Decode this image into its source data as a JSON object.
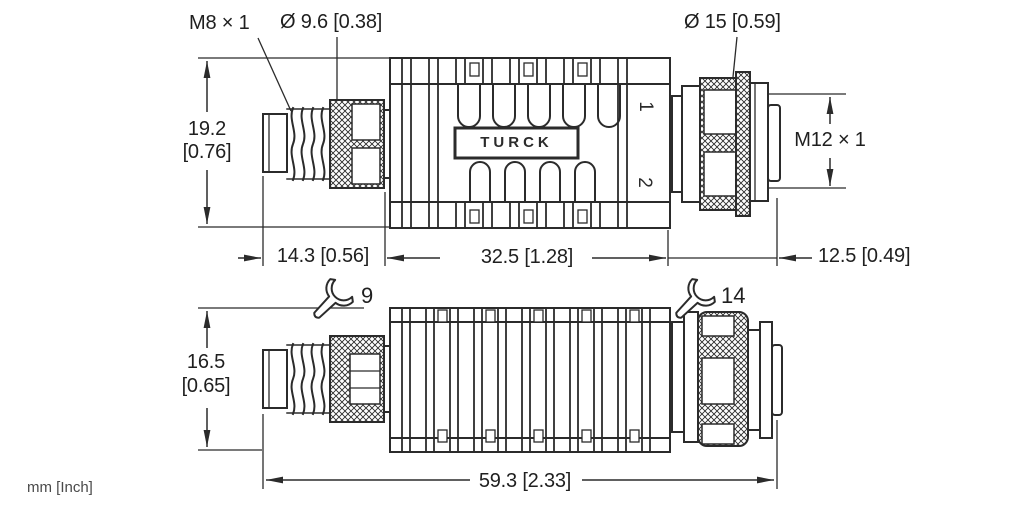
{
  "units_label": "mm [Inch]",
  "brand_label": "TURCK",
  "top_view": {
    "thread_left_label": "M8 × 1",
    "diameter_left_label": "Ø 9.6 [0.38]",
    "diameter_right_label": "Ø 15 [0.59]",
    "thread_right_label": "M12 × 1",
    "marker_1": "1",
    "marker_2": "2",
    "dim_height_mm": "19.2",
    "dim_height_inch": "[0.76]",
    "dim_left_length": "14.3 [0.56]",
    "dim_mid_length": "32.5 [1.28]",
    "dim_right_length": "12.5 [0.49]"
  },
  "bottom_view": {
    "dim_height_mm": "16.5",
    "dim_height_inch": "[0.65]",
    "dim_overall_length": "59.3 [2.33]"
  },
  "wrench_left_size": "9",
  "wrench_right_size": "14",
  "colors": {
    "line": "#2b2b2b",
    "text": "#1f1f1f",
    "background": "#ffffff"
  }
}
